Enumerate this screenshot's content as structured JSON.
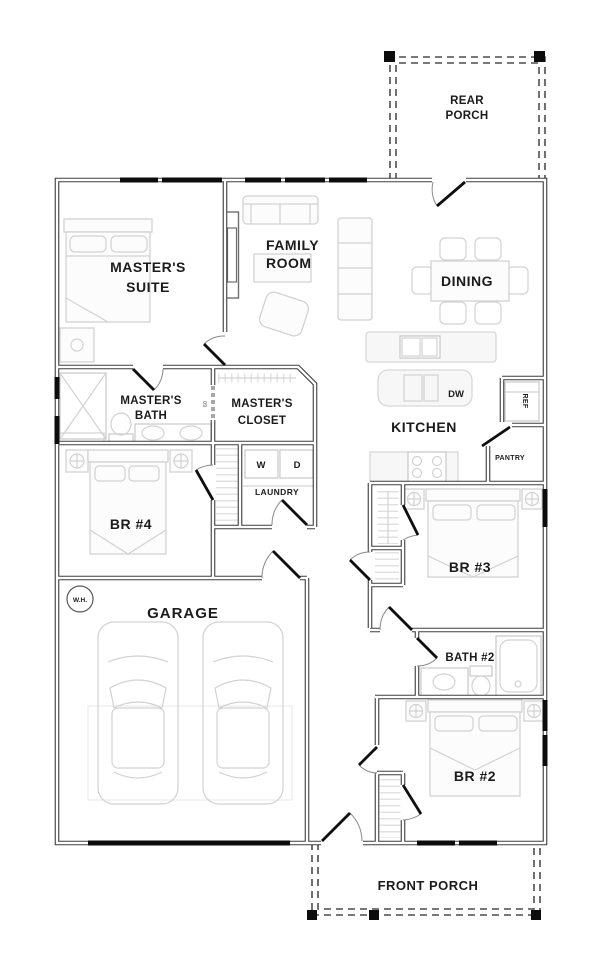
{
  "plan": {
    "rooms": {
      "rear_porch": {
        "line1": "REAR",
        "line2": "PORCH"
      },
      "master_suite": {
        "line1": "MASTER'S",
        "line2": "SUITE"
      },
      "family_room": {
        "line1": "FAMILY",
        "line2": "ROOM"
      },
      "dining": {
        "label": "DINING"
      },
      "kitchen": {
        "label": "KITCHEN"
      },
      "master_bath": {
        "line1": "MASTER'S",
        "line2": "BATH"
      },
      "master_closet": {
        "line1": "MASTER'S",
        "line2": "CLOSET"
      },
      "laundry": {
        "label": "LAUNDRY"
      },
      "br4": {
        "label": "BR #4"
      },
      "garage": {
        "label": "GARAGE"
      },
      "br3": {
        "label": "BR #3"
      },
      "bath2": {
        "label": "BATH #2"
      },
      "br2": {
        "label": "BR #2"
      },
      "front_porch": {
        "label": "FRONT PORCH"
      }
    },
    "labels": {
      "dw": "DW",
      "ref": "REF",
      "pantry": "PANTRY",
      "washer": "W",
      "dryer": "D",
      "water_heater": "W.H.",
      "door_width": "60"
    },
    "colors": {
      "wall": "#3d3d3d",
      "window": "#0c0c0c",
      "furniture": "#d2d2d2",
      "text": "#1b1b1b",
      "background": "#ffffff"
    }
  }
}
